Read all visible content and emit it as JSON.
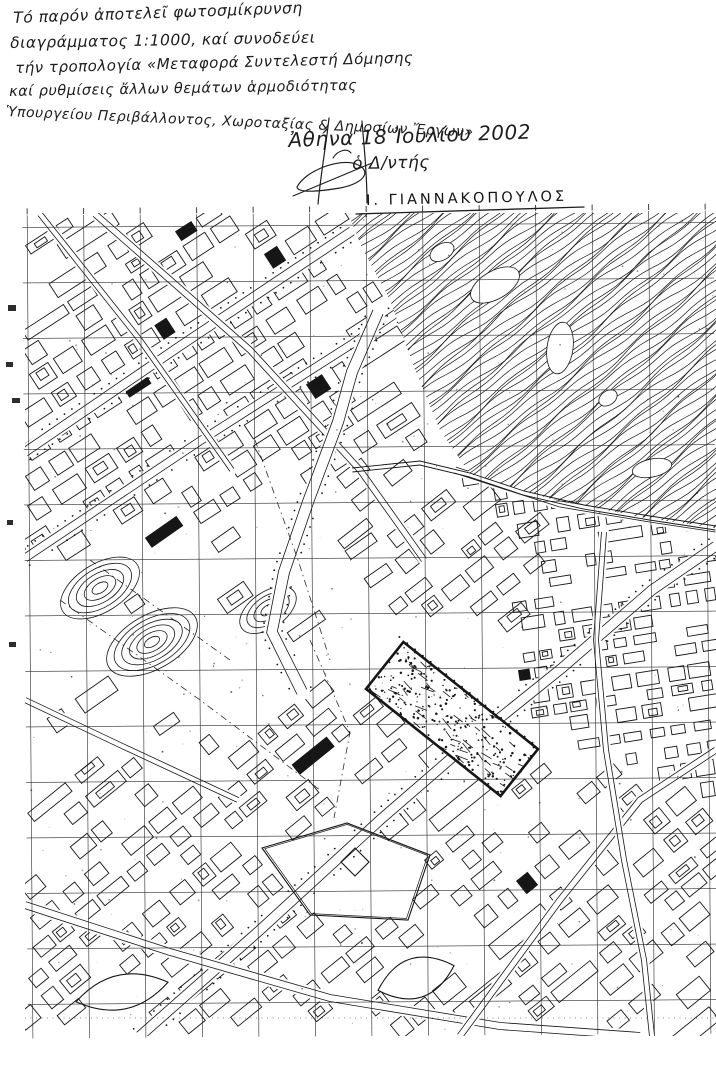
{
  "document": {
    "annotation_lines": [
      "Τό παρόν ἀποτελεῖ φωτοσμίκρυνση",
      "διαγράμματος 1:1000, καί συνοδεύει",
      "τήν τροπολογία «Μεταφορά Συντελεστή Δόμησης",
      "καί ρυθμίσεις ἄλλων θεμάτων ἁρμοδιότητας",
      "Ὑπουργείου Περιβάλλοντος, Χωροταξίας & Δημοσίων Ἔργων»"
    ],
    "date_line": "Ἀθήνα 18 Ἰουλίου 2002",
    "signer_title": "ὁ Δ/ντής",
    "signer_name": "Ι. ΓΙΑΝΝΑΚΟΠΟΥΛΟΣ",
    "map_scale": "1:1000"
  },
  "map": {
    "ink": "#161616",
    "paper": "#ffffff",
    "seed": 20020718,
    "area": {
      "left": 25,
      "top": 213,
      "right": 716,
      "bottom": 1036
    },
    "grid": {
      "x0": 30,
      "dx": 56.5,
      "y0": 225,
      "dy": 55.5,
      "tilt": -0.4
    },
    "contours": {
      "angle": -38,
      "spacing": 5.1,
      "origin": [
        348,
        213
      ],
      "poly": [
        [
          348,
          213
        ],
        [
          716,
          213
        ],
        [
          716,
          528
        ],
        [
          640,
          517
        ],
        [
          548,
          498
        ],
        [
          470,
          474
        ],
        [
          440,
          430
        ],
        [
          415,
          370
        ],
        [
          390,
          300
        ],
        [
          362,
          248
        ]
      ],
      "patches": [
        [
          495,
          285,
          27,
          14,
          -30
        ],
        [
          560,
          348,
          13,
          26,
          8
        ],
        [
          442,
          252,
          13,
          8,
          -30
        ],
        [
          652,
          468,
          20,
          9,
          -12
        ],
        [
          608,
          398,
          10,
          7,
          -35
        ]
      ],
      "edge": [
        [
          352,
          468
        ],
        [
          420,
          461
        ],
        [
          470,
          473
        ],
        [
          524,
          491
        ],
        [
          584,
          505
        ],
        [
          650,
          516
        ],
        [
          716,
          526
        ]
      ]
    },
    "hills": [
      [
        100,
        588,
        44,
        24,
        5,
        -32
      ],
      [
        152,
        642,
        50,
        27,
        6,
        -30
      ],
      [
        268,
        610,
        32,
        18,
        4,
        -35
      ]
    ],
    "districts": [
      {
        "poly": [
          [
            25,
            216
          ],
          [
            348,
            216
          ],
          [
            372,
            272
          ],
          [
            402,
            348
          ],
          [
            432,
            434
          ],
          [
            330,
            478
          ],
          [
            218,
            510
          ],
          [
            108,
            540
          ],
          [
            25,
            554
          ]
        ],
        "angle": -33,
        "cw": 20,
        "ch": 12,
        "gx": 7,
        "gy": 8,
        "density": 0.8,
        "seed": 11
      },
      {
        "poly": [
          [
            25,
            554
          ],
          [
            108,
            540
          ],
          [
            218,
            510
          ],
          [
            330,
            478
          ],
          [
            420,
            472
          ],
          [
            392,
            566
          ],
          [
            330,
            646
          ],
          [
            236,
            724
          ],
          [
            118,
            764
          ],
          [
            25,
            774
          ]
        ],
        "angle": -35,
        "cw": 27,
        "ch": 12,
        "gx": 17,
        "gy": 24,
        "density": 0.42,
        "seed": 22
      },
      {
        "poly": [
          [
            336,
            474
          ],
          [
            452,
            466
          ],
          [
            528,
            498
          ],
          [
            558,
            546
          ],
          [
            498,
            644
          ],
          [
            414,
            642
          ],
          [
            354,
            566
          ]
        ],
        "angle": -38,
        "cw": 23,
        "ch": 12,
        "gx": 8,
        "gy": 10,
        "density": 0.72,
        "seed": 33
      },
      {
        "poly": [
          [
            458,
            470
          ],
          [
            716,
            534
          ],
          [
            716,
            794
          ],
          [
            564,
            746
          ],
          [
            502,
            664
          ],
          [
            536,
            542
          ]
        ],
        "angle": -9,
        "cw": 15,
        "ch": 10,
        "gx": 6,
        "gy": 7,
        "density": 0.82,
        "seed": 44
      },
      {
        "poly": [
          [
            25,
            774
          ],
          [
            236,
            726
          ],
          [
            356,
            666
          ],
          [
            432,
            704
          ],
          [
            560,
            750
          ],
          [
            716,
            798
          ],
          [
            716,
            1034
          ],
          [
            25,
            1034
          ]
        ],
        "angle": -39,
        "cw": 21,
        "ch": 13,
        "gx": 8,
        "gy": 10,
        "density": 0.7,
        "seed": 55
      }
    ],
    "roads": [
      {
        "pts": [
          [
            25,
            452
          ],
          [
            180,
            346
          ],
          [
            352,
            231
          ]
        ],
        "w": 9,
        "dots": true
      },
      {
        "pts": [
          [
            25,
            558
          ],
          [
            200,
            441
          ],
          [
            352,
            344
          ],
          [
            470,
            262
          ],
          [
            528,
            220
          ]
        ],
        "w": 8,
        "dots": true
      },
      {
        "pts": [
          [
            95,
            214
          ],
          [
            250,
            350
          ],
          [
            360,
            470
          ],
          [
            424,
            560
          ]
        ],
        "w": 6,
        "dots": false
      },
      {
        "pts": [
          [
            40,
            214
          ],
          [
            140,
            340
          ],
          [
            232,
            470
          ]
        ],
        "w": 5,
        "dots": false
      },
      {
        "pts": [
          [
            378,
            312
          ],
          [
            352,
            372
          ],
          [
            338,
            422
          ],
          [
            308,
            502
          ],
          [
            284,
            572
          ],
          [
            272,
            632
          ],
          [
            302,
            692
          ]
        ],
        "w": 11,
        "dots": true
      },
      {
        "pts": [
          [
            140,
            1036
          ],
          [
            260,
            930
          ],
          [
            380,
            820
          ],
          [
            470,
            742
          ],
          [
            562,
            668
          ],
          [
            652,
            590
          ],
          [
            716,
            546
          ]
        ],
        "w": 10,
        "dots": true
      },
      {
        "pts": [
          [
            25,
            905
          ],
          [
            170,
            952
          ],
          [
            330,
            998
          ],
          [
            500,
            1026
          ],
          [
            640,
            1036
          ]
        ],
        "w": 7,
        "dots": false
      },
      {
        "pts": [
          [
            460,
            1036
          ],
          [
            560,
            900
          ],
          [
            640,
            800
          ],
          [
            716,
            750
          ]
        ],
        "w": 6,
        "dots": false
      },
      {
        "pts": [
          [
            455,
            470
          ],
          [
            560,
            504
          ],
          [
            650,
            519
          ],
          [
            716,
            529
          ]
        ],
        "w": 6,
        "dots": false
      },
      {
        "pts": [
          [
            604,
            532
          ],
          [
            596,
            640
          ],
          [
            606,
            750
          ],
          [
            624,
            860
          ],
          [
            644,
            960
          ],
          [
            652,
            1036
          ]
        ],
        "w": 5,
        "dots": false
      },
      {
        "pts": [
          [
            25,
            700
          ],
          [
            120,
            745
          ],
          [
            238,
            800
          ]
        ],
        "w": 5,
        "dots": false
      }
    ],
    "dashes": [
      {
        "pts": [
          [
            60,
            600
          ],
          [
            200,
            700
          ],
          [
            320,
            790
          ]
        ],
        "fine": false
      },
      {
        "pts": [
          [
            90,
            560
          ],
          [
            230,
            660
          ]
        ],
        "fine": false
      },
      {
        "pts": [
          [
            310,
            640
          ],
          [
            350,
            732
          ],
          [
            334,
            818
          ]
        ],
        "fine": false
      },
      {
        "pts": [
          [
            255,
            440
          ],
          [
            298,
            560
          ],
          [
            330,
            660
          ]
        ],
        "fine": false
      },
      {
        "pts": [
          [
            25,
            1018
          ],
          [
            714,
            1018
          ]
        ],
        "fine": true
      }
    ],
    "metro_site": {
      "cx": 452,
      "cy": 719,
      "len": 172,
      "wid": 60,
      "angle": 38.5,
      "border": 2.6
    },
    "landmarks": {
      "diamond": [
        [
          262,
          848
        ],
        [
          347,
          823
        ],
        [
          430,
          855
        ],
        [
          408,
          920
        ],
        [
          310,
          915
        ]
      ],
      "inner_diamond": [
        [
          355,
          848
        ],
        [
          369,
          862
        ],
        [
          355,
          876
        ],
        [
          341,
          862
        ]
      ],
      "lenses": [
        [
          122,
          992,
          47,
          19,
          -12
        ],
        [
          416,
          978,
          40,
          22,
          -18
        ]
      ]
    },
    "margin_specks": [
      [
        8,
        305,
        8,
        6
      ],
      [
        6,
        362,
        7,
        5
      ],
      [
        12,
        398,
        8,
        5
      ],
      [
        7,
        520,
        6,
        5
      ],
      [
        9,
        642,
        7,
        5
      ]
    ]
  }
}
